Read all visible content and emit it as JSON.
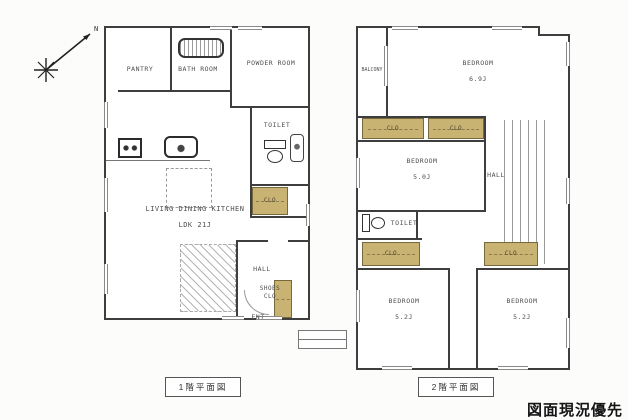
{
  "stamp": "図面現況優先",
  "captions": {
    "floor1": "1階平面図",
    "floor2": "2階平面図"
  },
  "compass": {
    "north": "N"
  },
  "colors": {
    "closet_fill": "#c9b372",
    "wall": "#3e3e3e",
    "paper": "#fcfcfb"
  },
  "floor1": {
    "pantry": "PANTRY",
    "bathroom": "BATH ROOM",
    "powder_room": "POWDER ROOM",
    "toilet": "TOILET",
    "closet": "CLO",
    "ldk_line1": "LIVING DINING KITCHEN",
    "ldk_line2": "LDK 21J",
    "hall": "HALL",
    "shoes_closet_line1": "SHOES",
    "shoes_closet_line2": "CLO",
    "entrance": "ENT"
  },
  "floor2": {
    "balcony": "BALCONY",
    "bedroom_main": {
      "name": "BEDROOM",
      "size": "6.9J"
    },
    "closet_a": "CLO",
    "closet_b": "CLO",
    "bedroom_mid": {
      "name": "BEDROOM",
      "size": "5.0J"
    },
    "hall": "HALL",
    "toilet": "TOILET",
    "closet_c": "CLO",
    "closet_d": "CLO",
    "bedroom_left": {
      "name": "BEDROOM",
      "size": "5.2J"
    },
    "bedroom_right": {
      "name": "BEDROOM",
      "size": "5.2J"
    }
  }
}
